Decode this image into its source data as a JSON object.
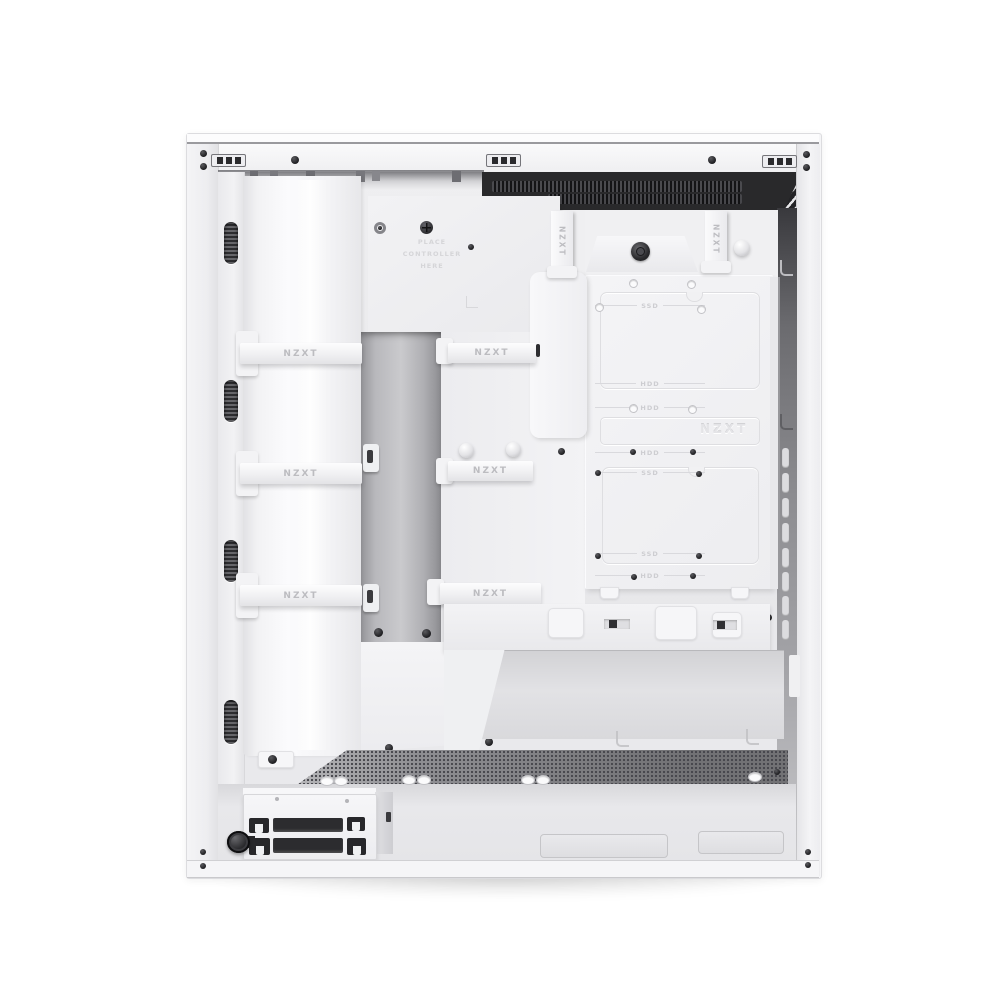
{
  "meta": {
    "type": "product-photo",
    "subject": "White mid-tower PC case interior, cable-management side with side panel removed",
    "background": "#ffffff"
  },
  "labels": {
    "brand": "NZXT",
    "controller_hint": [
      "PLACE",
      "CONTROLLER",
      "HERE"
    ]
  },
  "straps": {
    "left": [
      "NZXT",
      "NZXT",
      "NZXT"
    ],
    "middle": [
      "NZXT",
      "NZXT",
      "NZXT"
    ],
    "vertical": [
      "NZXT",
      "NZXT"
    ]
  },
  "drive_tray": {
    "emboss": "NZXT",
    "markings": [
      "SSD",
      "HDD",
      "HDD",
      "HDD",
      "SSD",
      "SSD",
      "HDD"
    ]
  },
  "colors": {
    "case_white": "#f5f5f7",
    "panel_shadow": "#d9d9dc",
    "recess_dark": "#29292b",
    "channel_gray": "#bdbdc1",
    "mesh_gray": "#8e8e92",
    "knob_black": "#1c1c1f",
    "strap_text": "#bcbcc0",
    "emboss_text": "#e4e4e7"
  }
}
